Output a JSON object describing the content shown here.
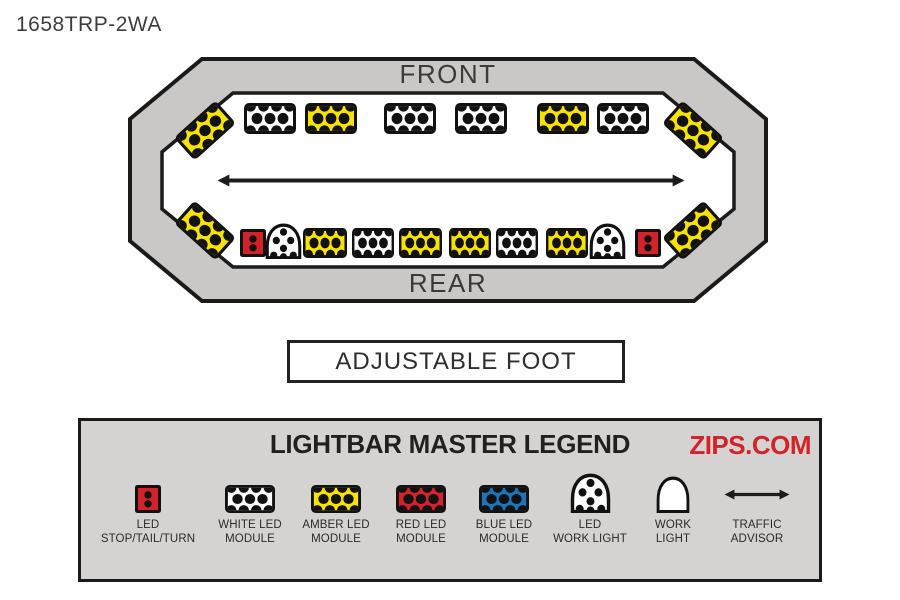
{
  "page": {
    "model_number": "1658TRP-2WA"
  },
  "colors": {
    "amber": "#f8e300",
    "red": "#d2232a",
    "blue": "#1b75bc",
    "white": "#ffffff",
    "black": "#111111",
    "bar_gray": "#cac8c6",
    "legend_gray": "#d5d3d1",
    "zips_red": "#d2232a"
  },
  "lightbar": {
    "front_label": "FRONT",
    "rear_label": "REAR",
    "front_corner_modules": [
      "amber",
      "amber"
    ],
    "front_row_modules": [
      "white",
      "amber",
      "white",
      "white",
      "amber",
      "white"
    ],
    "center_element": "traffic-advisor-arrow",
    "rear_row_modules": [
      "stop",
      "led_work",
      "amber",
      "white",
      "amber",
      "amber",
      "white",
      "amber",
      "led_work",
      "stop"
    ],
    "rear_corner_modules": [
      "amber",
      "amber"
    ]
  },
  "adjustable_foot": {
    "label": "ADJUSTABLE FOOT"
  },
  "legend": {
    "title": "LIGHTBAR MASTER LEGEND",
    "brand": "ZIPS.COM",
    "items": [
      {
        "icon": "stop",
        "label_line1": "LED",
        "label_line2": "STOP/TAIL/TURN"
      },
      {
        "icon": "white",
        "label_line1": "WHITE LED",
        "label_line2": "MODULE"
      },
      {
        "icon": "amber",
        "label_line1": "AMBER LED",
        "label_line2": "MODULE"
      },
      {
        "icon": "red",
        "label_line1": "RED LED",
        "label_line2": "MODULE"
      },
      {
        "icon": "blue",
        "label_line1": "BLUE LED",
        "label_line2": "MODULE"
      },
      {
        "icon": "led_work",
        "label_line1": "LED",
        "label_line2": "WORK LIGHT"
      },
      {
        "icon": "work",
        "label_line1": "WORK",
        "label_line2": "LIGHT"
      },
      {
        "icon": "arrow",
        "label_line1": "TRAFFIC",
        "label_line2": "ADVISOR"
      }
    ]
  }
}
